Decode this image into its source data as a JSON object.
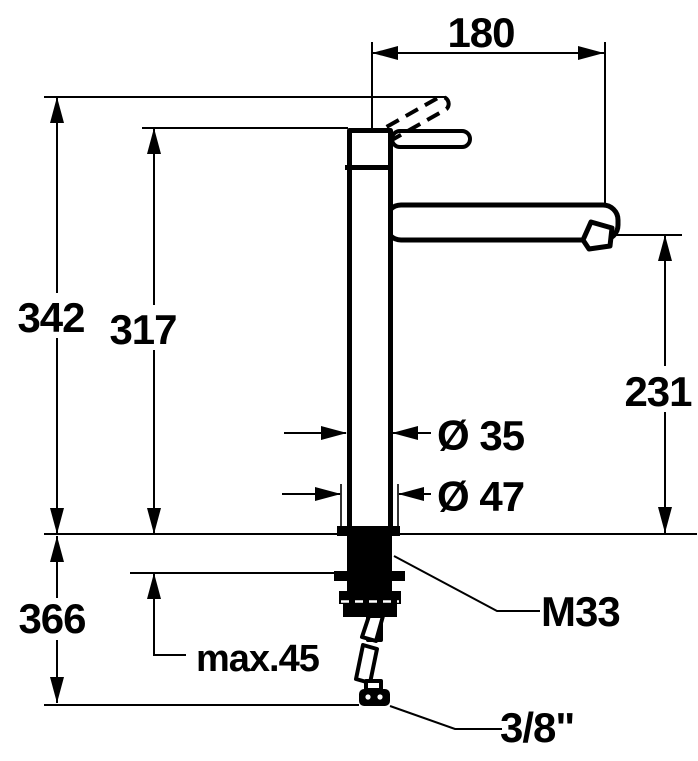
{
  "drawing": {
    "type": "technical-dimension-drawing",
    "subject": "single-lever high-spout basin mixer tap, side elevation",
    "background_color": "#ffffff",
    "line_color": "#000000",
    "labels": {
      "spout_reach": "180",
      "overall_height": "342",
      "body_height": "317",
      "outlet_height": "231",
      "body_diameter": "Ø 35",
      "base_diameter": "Ø 47",
      "below_deck_length": "366",
      "max_deck_thickness": "max.45",
      "fixing_thread": "M33",
      "supply_connection": "3/8\""
    }
  }
}
